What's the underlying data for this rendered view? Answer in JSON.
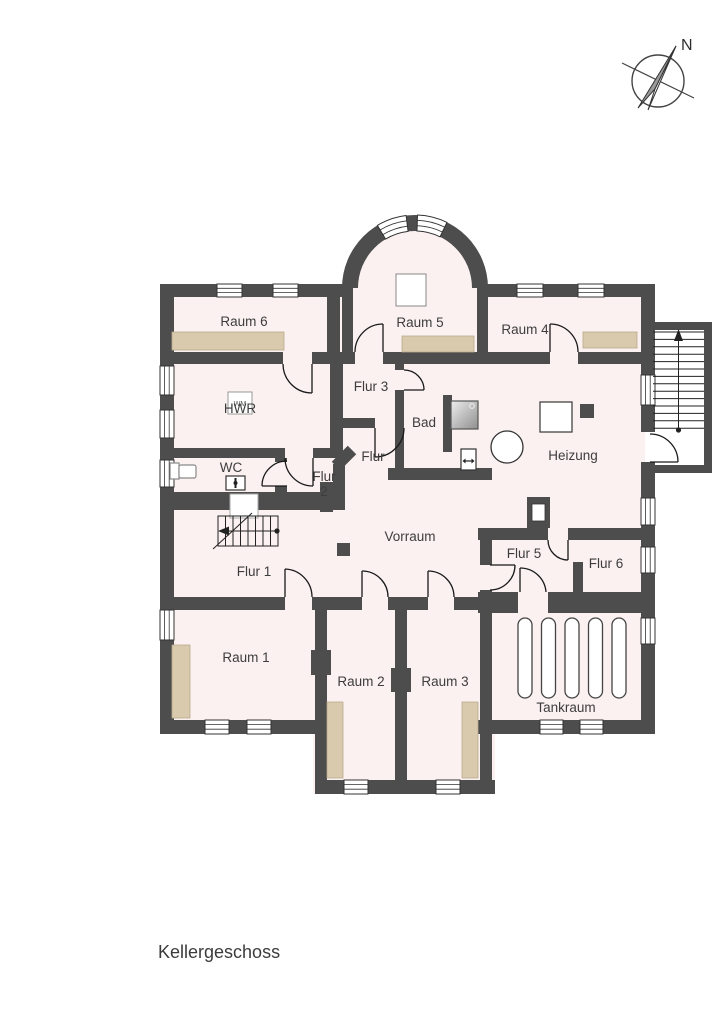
{
  "floor_title": "Kellergeschoss",
  "compass": {
    "label": "N"
  },
  "rooms": {
    "raum6": {
      "label": "Raum 6"
    },
    "raum5": {
      "label": "Raum 5"
    },
    "raum4": {
      "label": "Raum 4"
    },
    "hwr": {
      "label": "HWR"
    },
    "flur3": {
      "label": "Flur 3"
    },
    "bad": {
      "label": "Bad"
    },
    "heizung": {
      "label": "Heizung"
    },
    "wc": {
      "label": "WC"
    },
    "flur2": {
      "label": "Flur",
      "number": "2"
    },
    "flur": {
      "label": "Flur"
    },
    "vorraum": {
      "label": "Vorraum"
    },
    "flur1": {
      "label": "Flur 1"
    },
    "flur5": {
      "label": "Flur 5"
    },
    "flur6": {
      "label": "Flur 6"
    },
    "raum1": {
      "label": "Raum 1"
    },
    "raum2": {
      "label": "Raum 2"
    },
    "raum3": {
      "label": "Raum 3"
    },
    "tankraum": {
      "label": "Tankraum"
    }
  },
  "appliances": {
    "washing_machine_label": "WM"
  },
  "features": [
    "shower",
    "toilet",
    "washbasin",
    "boiler",
    "oil-tanks",
    "stairs-up",
    "stairs-down",
    "chimney"
  ],
  "tank_count": 5,
  "colors": {
    "wall": "#4d4d4d",
    "floor": "#fcf1f1",
    "furniture": "#d9c9ad",
    "background": "#ffffff"
  }
}
